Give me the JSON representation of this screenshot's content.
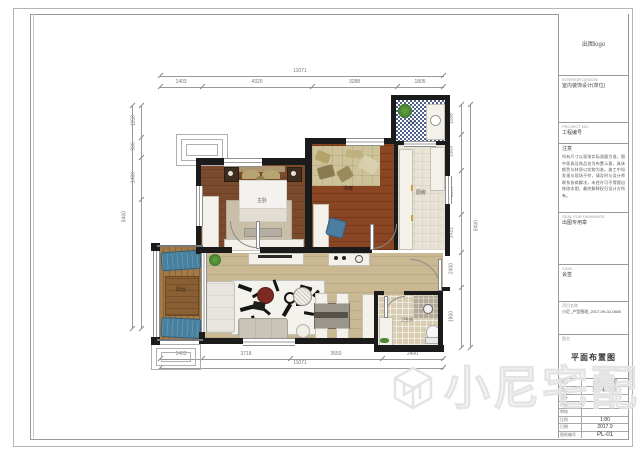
{
  "title_block": {
    "logo": "出图logo",
    "firm_caption": "INTERIOR DESIGN",
    "firm": "室内装饰设计(单位)",
    "project_no_caption": "PROJECT NO.",
    "project_no": "工程编号",
    "note_label": "注意",
    "note_text": "所有尺寸以现场实际测量为准，图中家具及饰品仅为布置示意，具体颜色与材质以实物为准。施工中如发现与现场不符，请及时与设计师联系协商解决，未经许可不得擅自修改本图，最终解释权归设计方所有。",
    "stamp_caption": "SEAL FOR DRAWINGS",
    "stamp": "出图专用章",
    "countersign_caption": "SIGN",
    "countersign": "会签",
    "project_name_caption": "PROJECT NAME",
    "project_name_label": "项目名称",
    "project_name": "小尼_户型图改_2017-09-02-0800",
    "drawing_label": "图名",
    "drawing_title": "平面布置图",
    "rows": [
      {
        "label": "项目",
        "value": "六楼施工图"
      },
      {
        "label": "楼型",
        "value": "别墅/电梯洋房"
      },
      {
        "label": "设计",
        "value": ""
      },
      {
        "label": "制图",
        "value": ""
      },
      {
        "label": "审核",
        "value": ""
      },
      {
        "label": "比例",
        "value": "1:80"
      },
      {
        "label": "日期",
        "value": "2017.9"
      },
      {
        "label": "图纸编号",
        "value": "PL-01"
      }
    ]
  },
  "plan": {
    "rooms": {
      "master": "主卧",
      "study": "书房",
      "kitchen": "厨房",
      "bath": "卫生间",
      "balcony_left": "阳台",
      "balcony_top": "阳台"
    },
    "dims": {
      "top_overall": "11071",
      "top_segs": [
        "1403",
        "4320",
        "3288",
        "1805"
      ],
      "bottom_overall": "11071",
      "bottom_segs": [
        "1403",
        "3718",
        "3550",
        "2400"
      ],
      "left_overall": "8400",
      "left_segs": [
        "1158",
        "900",
        "1400"
      ],
      "right_overall": "8400",
      "right_segs": [
        "1188",
        "1303",
        "2130",
        "1421",
        "2400",
        "1800"
      ]
    }
  },
  "watermark": "小尼宅配",
  "colors": {
    "wall": "#1b1b1b",
    "wood_bedroom": "#7b4a2d",
    "wood_study": "#8a4522",
    "wood_living": "#cab893",
    "balcony_wood": "#a37947",
    "tatami": "#cdc298",
    "mosaic_blue": "#50608c",
    "accent_blue": "#4d7da0",
    "coffee_table_red": "#7a2a22",
    "plant_green": "#4e8a33"
  }
}
